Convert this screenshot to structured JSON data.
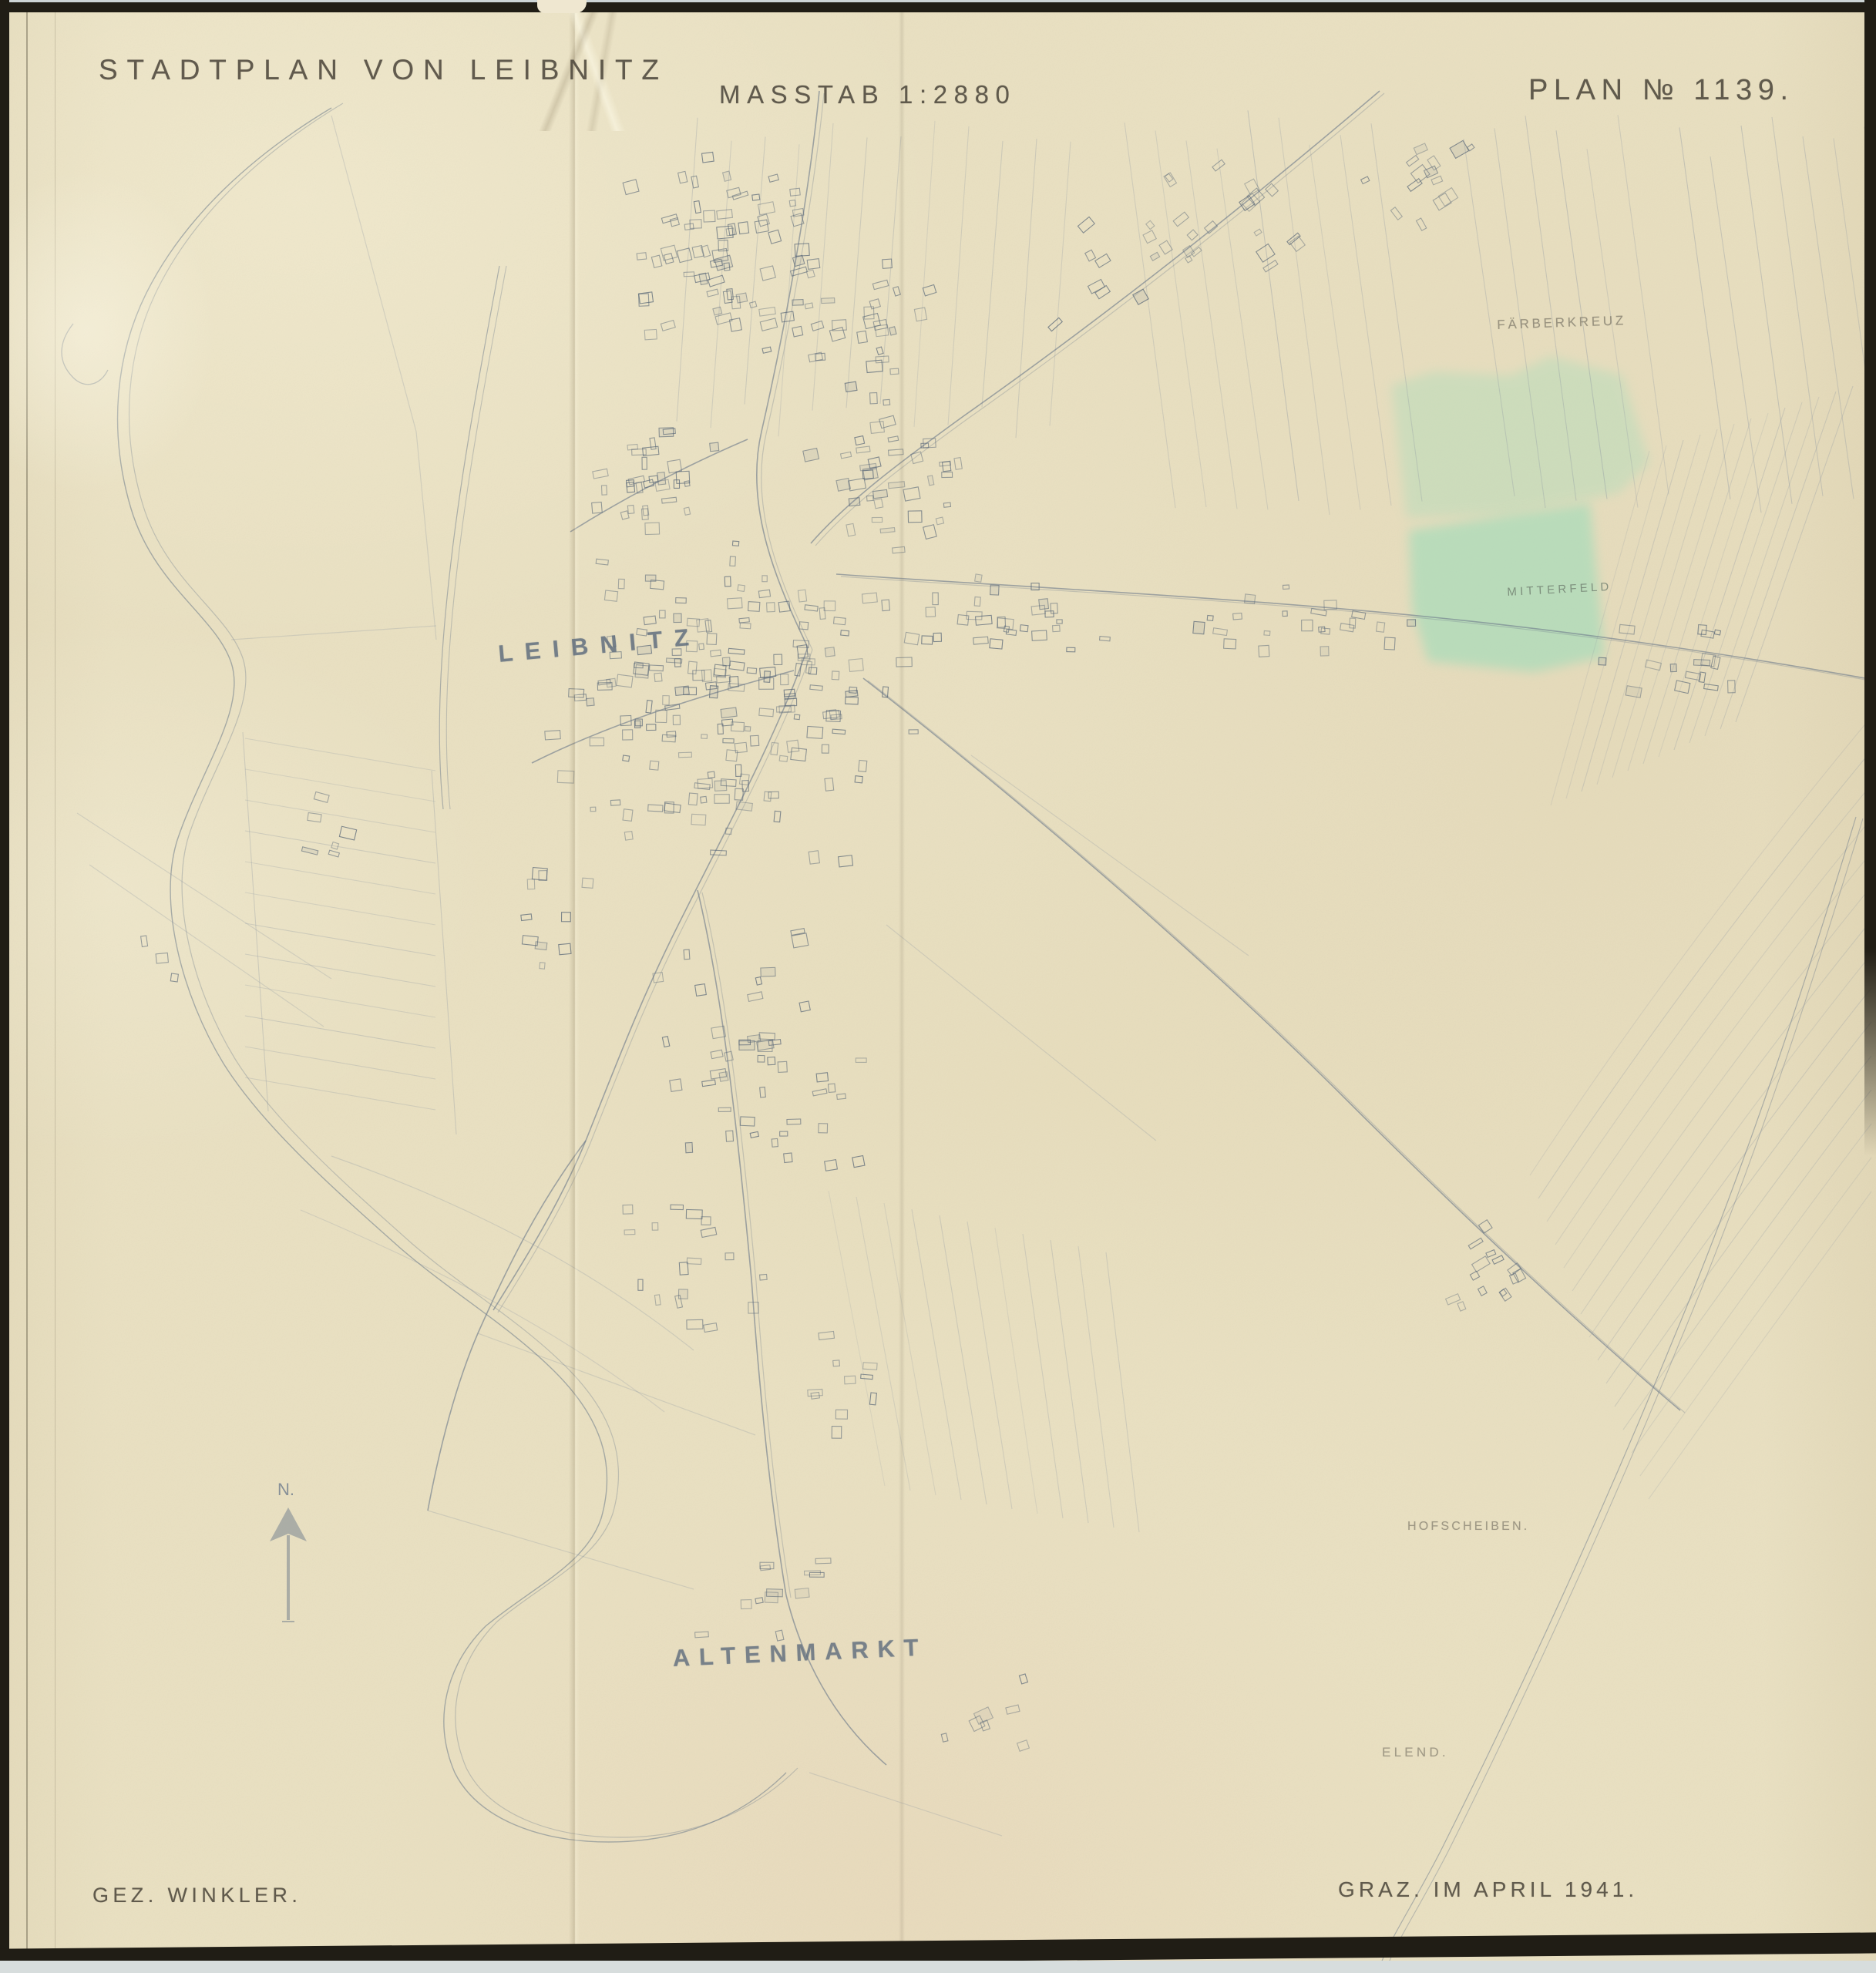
{
  "header": {
    "title": "STADTPLAN VON LEIBNITZ",
    "scale_label": "MASSTAB 1:2880",
    "plan_number": "PLAN № 1139."
  },
  "footer": {
    "drawn_by": "GEZ. WINKLER.",
    "place_date": "GRAZ. IM APRIL 1941."
  },
  "map_labels": {
    "town": "LEIBNITZ",
    "south_district": "ALTENMARKT",
    "field_faerberkreuz": "FÄRBERKREUZ",
    "field_mitterfeld": "MITTERFELD",
    "field_hofscheiben": "HOFSCHEIBEN.",
    "field_elend": "ELEND.",
    "north_mark": "N."
  },
  "colors": {
    "paper": "#e9e0c1",
    "ink": "#6e7b8b",
    "ink_dark": "#5a6878",
    "ink_faint": "#8a94a1",
    "pencil_text": "#4e483d",
    "field_green": "#9fdcba",
    "border_black": "#201d15",
    "scanner_background": "#d7dddd"
  }
}
